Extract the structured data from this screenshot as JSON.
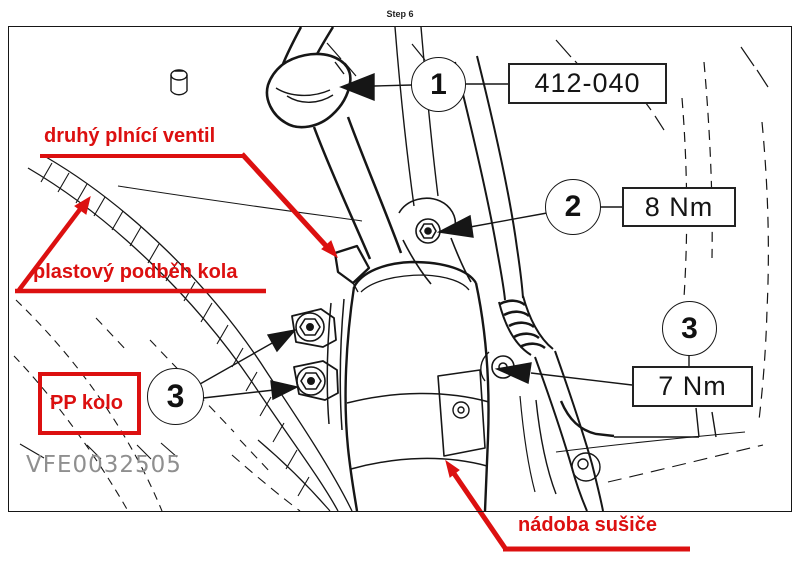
{
  "page": {
    "step_label": "Step 6",
    "figure_code": "VFE0032505"
  },
  "colors": {
    "annotation_red": "#dc1010",
    "line_black": "#161616"
  },
  "callouts": {
    "one": {
      "number": "1",
      "value": "412-040"
    },
    "two": {
      "number": "2",
      "value": "8 Nm"
    },
    "three_left": {
      "number": "3"
    },
    "three_right": {
      "number": "3",
      "value": "7 Nm"
    }
  },
  "annotations": {
    "second_fill_valve": "druhý plnící ventil",
    "plastic_wheel_arch": "plastový podběh kola",
    "pp_wheel": "PP kolo",
    "drier_container": "nádoba sušiče"
  }
}
